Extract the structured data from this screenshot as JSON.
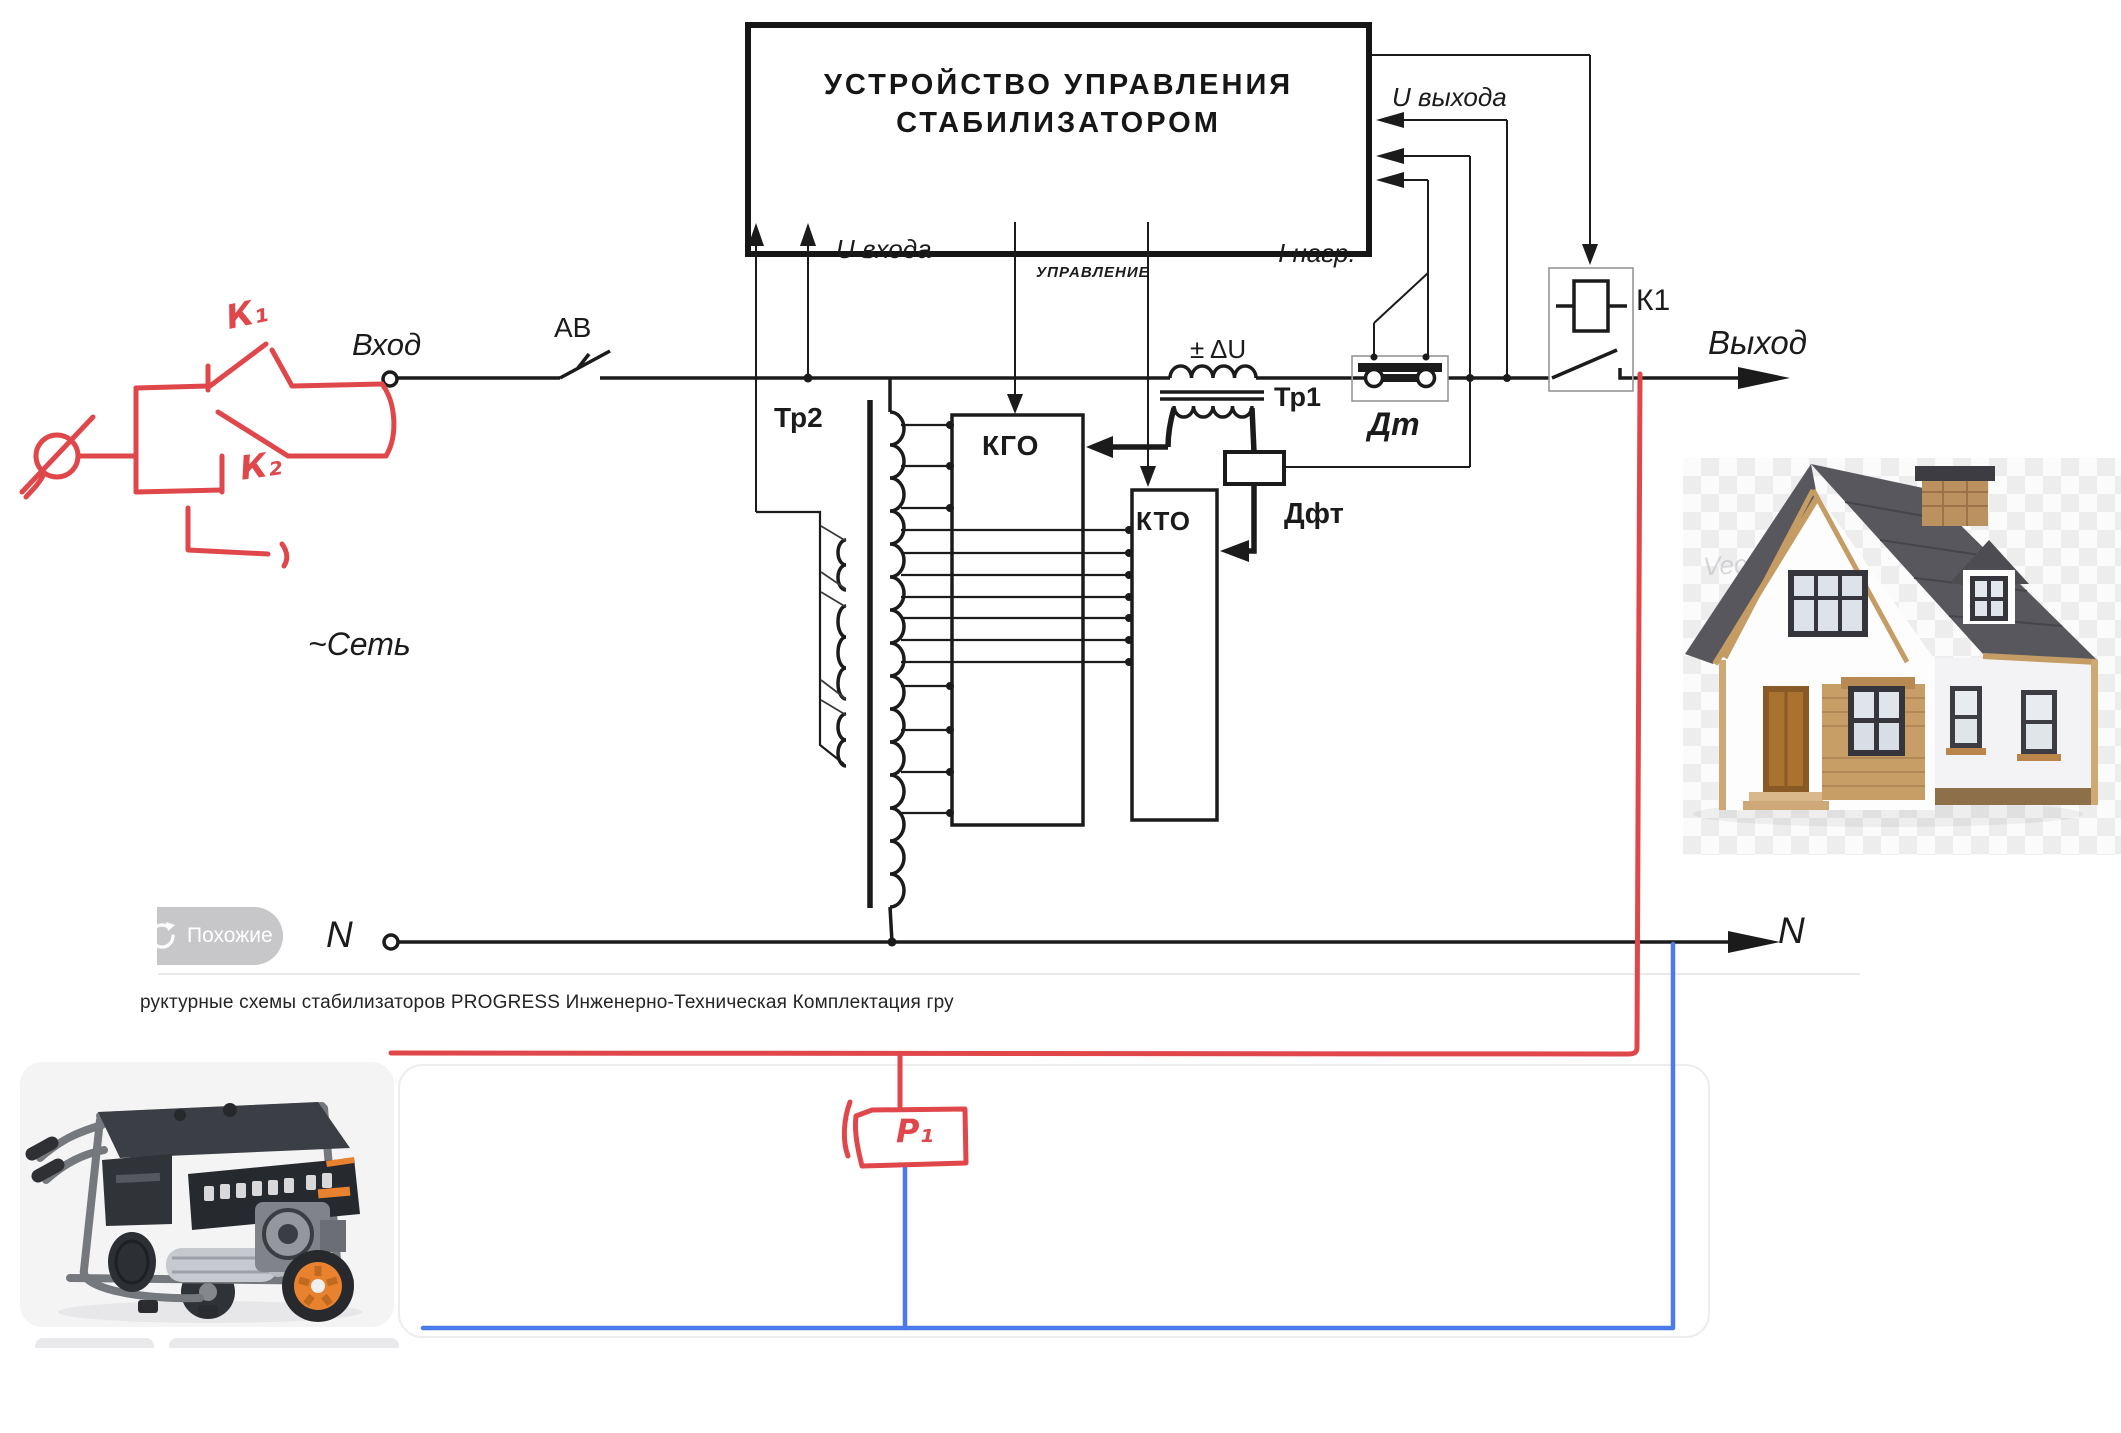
{
  "viewer": {
    "similar_button_label": "Похожие",
    "caption": "руктурные схемы стабилизаторов PROGRESS Инженерно-Техническая Комплектация гру",
    "watermark": "Vecteezy"
  },
  "schematic": {
    "control_unit_line1": "УСТРОЙСТВО  УПРАВЛЕНИЯ",
    "control_unit_line2": "СТАБИЛИЗАТОРОМ",
    "labels": {
      "input": "Вход",
      "breaker": "АВ",
      "output": "Выход",
      "mains": "~Сеть",
      "u_input": "U входа",
      "u_output": "U выхода",
      "control": "УПРАВЛЕНИЕ",
      "i_load": "I нагр.",
      "delta_u": "± ΔU",
      "tr1": "Тр1",
      "tr2": "Тр2",
      "current_sensor": "Дт",
      "dft": "Дфт",
      "kgo": "КГО",
      "kto": "КТО",
      "k1_relay": "К1",
      "neutral_left": "N",
      "neutral_right": "N"
    },
    "hand_annotations": {
      "k1": "К₁",
      "k2": "К₂",
      "p1": "Р₁"
    },
    "colors": {
      "annotation_red": "#e0474b",
      "neutral_blue": "#4b7be9",
      "line_black": "#1b1b1b"
    }
  }
}
